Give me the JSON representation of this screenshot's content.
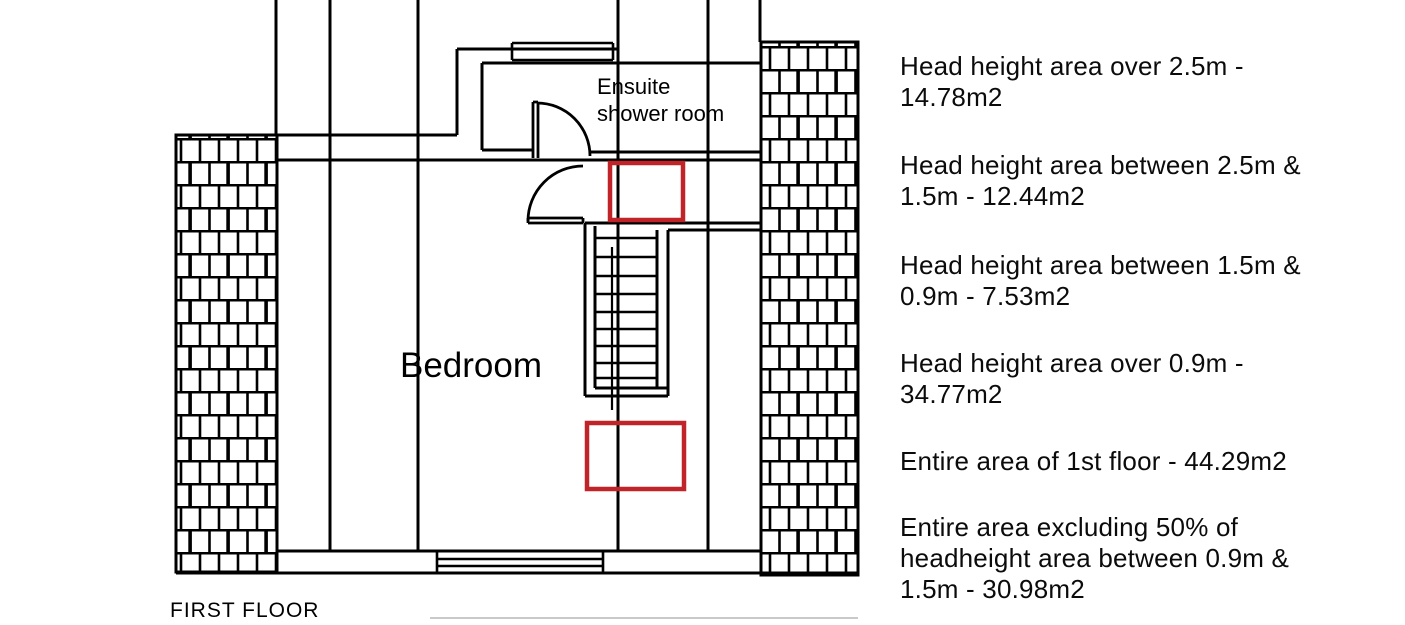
{
  "colors": {
    "line_black": "#000000",
    "highlight_red": "#c02428"
  },
  "plan": {
    "labels": {
      "ensuite_line1": "Ensuite",
      "ensuite_line2": "shower room",
      "bedroom": "Bedroom",
      "floor": "FIRST FLOOR"
    }
  },
  "annotations": [
    {
      "lines": [
        "Head height area over 2.5m -",
        "14.78m2"
      ]
    },
    {
      "lines": [
        "Head height area between 2.5m &",
        "1.5m - 12.44m2"
      ]
    },
    {
      "lines": [
        "Head height area between 1.5m &",
        "0.9m - 7.53m2"
      ]
    },
    {
      "lines": [
        "Head height area over 0.9m -",
        "34.77m2"
      ]
    },
    {
      "lines": [
        "Entire area of 1st floor - 44.29m2"
      ]
    },
    {
      "lines": [
        "Entire area excluding 50% of",
        "headheight area between 0.9m &",
        "1.5m - 30.98m2"
      ]
    }
  ]
}
